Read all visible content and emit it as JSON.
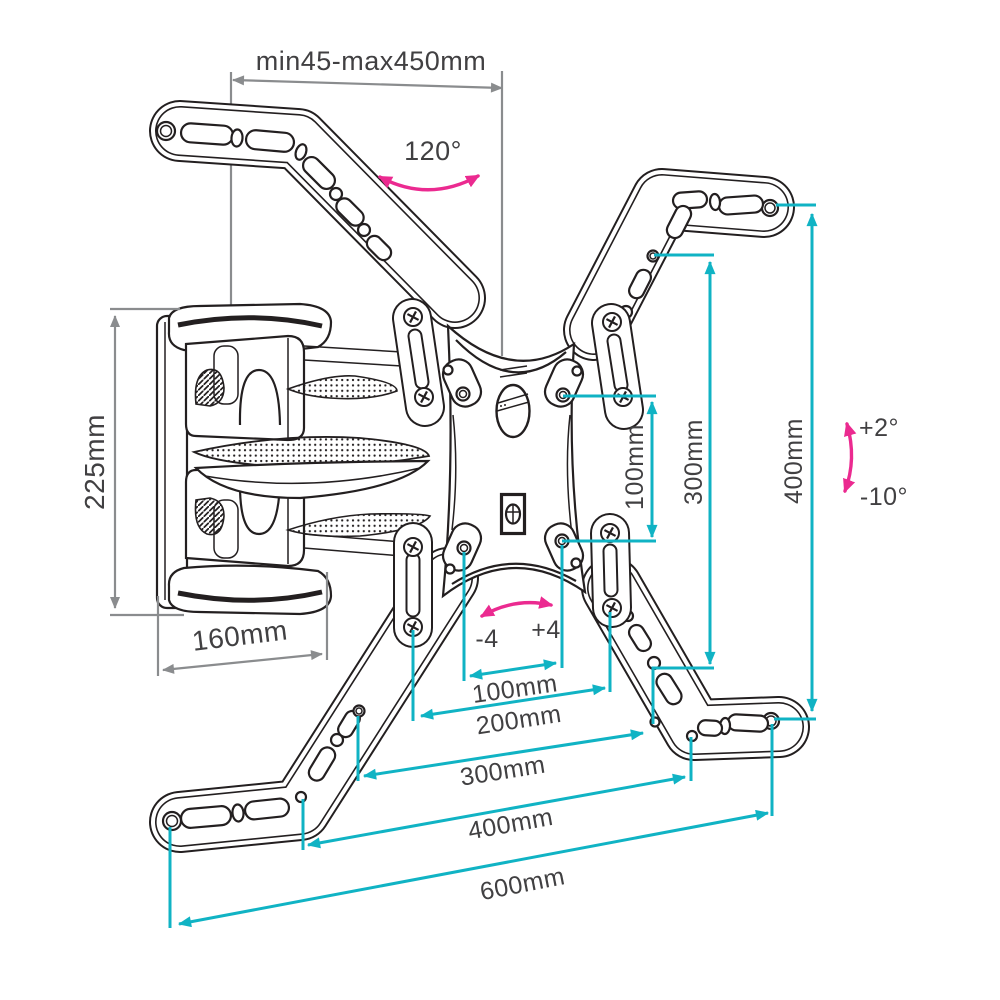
{
  "diagram": {
    "type": "technical-dimension-diagram",
    "colors": {
      "linework": "#231f20",
      "dimension_primary": "#10b3c4",
      "dimension_secondary": "#8a8c8e",
      "angle_accent": "#eb2a90",
      "label_text": "#414042",
      "background": "#ffffff"
    }
  },
  "labels": {
    "extension_range": "min45-max450mm",
    "swivel_angle": "120°",
    "wall_plate_height": "225mm",
    "arm_depth": "160mm",
    "vesa_vertical_100": "100mm",
    "height_300": "300mm",
    "height_400": "400mm",
    "tilt_up": "+2°",
    "tilt_down": "-10°",
    "level_minus": "-4",
    "level_plus": "+4",
    "width_100": "100mm",
    "width_200": "200mm",
    "width_300": "300mm",
    "width_400": "400mm",
    "width_600": "600mm"
  }
}
